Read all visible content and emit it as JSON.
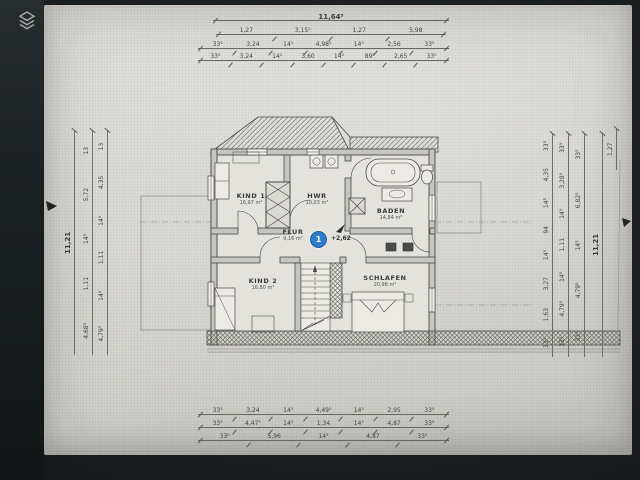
{
  "viewer": {
    "icons": {
      "layers": "stacked-layers",
      "section_arrow_left": "small-black-triangle",
      "section_arrow_right": "small-black-triangle",
      "level_arrow": "small-black-triangle"
    }
  },
  "plan": {
    "rooms": [
      {
        "name": "KIND 1",
        "area": "16,97 m²"
      },
      {
        "name": "HWR",
        "area": "10,03 m²"
      },
      {
        "name": "BADEN",
        "area": "14,84 m²"
      },
      {
        "name": "FLUR",
        "area": "9,16 m²"
      },
      {
        "name": "KIND 2",
        "area": "16,80 m²"
      },
      {
        "name": "SCHLAFEN",
        "area": "20,98 m²"
      }
    ],
    "level_marker": {
      "number": "1",
      "value": "+2,62"
    }
  },
  "dims": {
    "top": {
      "total": "11,64⁵",
      "row1": [
        "1,27",
        "3,15⁵",
        "1,27",
        "5,98"
      ],
      "row2": [
        "33⁵",
        "3,24",
        "14⁵",
        "4,98⁵",
        "14⁵",
        "2,56",
        "33⁵"
      ],
      "row3": [
        "33⁵",
        "3,24",
        "14⁵",
        "3,60",
        "14⁵",
        "89⁵",
        "2,65",
        "33⁵"
      ]
    },
    "bottom": {
      "row1": [
        "33⁵",
        "3,24",
        "14⁵",
        "4,49⁵",
        "14⁵",
        "2,95",
        "33⁵"
      ],
      "row2": [
        "33⁵",
        "4,47⁵",
        "14⁵",
        "1,34",
        "14⁵",
        "4,87",
        "33⁵"
      ],
      "row3": [
        "33⁵",
        "5,96",
        "14⁵",
        "4,87",
        "33⁵"
      ]
    },
    "left": {
      "total": "11,21",
      "col1": [
        "13",
        "4,35",
        "14⁵",
        "1,11",
        "14⁵",
        "4,79⁵"
      ],
      "col2": [
        "13",
        "5,72",
        "14⁵",
        "1,11",
        "4,68⁵"
      ]
    },
    "right": {
      "total": "11,21",
      "outer": "1,27",
      "col1": [
        "33⁵",
        "4,35",
        "14⁵",
        "94",
        "14⁵",
        "3,27",
        "1,63",
        "33⁵"
      ],
      "col2": [
        "33⁵",
        "3,28⁵",
        "14⁵",
        "1,11",
        "14⁵",
        "4,79⁵",
        "33⁵"
      ],
      "col3": [
        "33⁵",
        "6,82⁵",
        "14⁵",
        "4,79⁵",
        "33⁵"
      ]
    }
  }
}
